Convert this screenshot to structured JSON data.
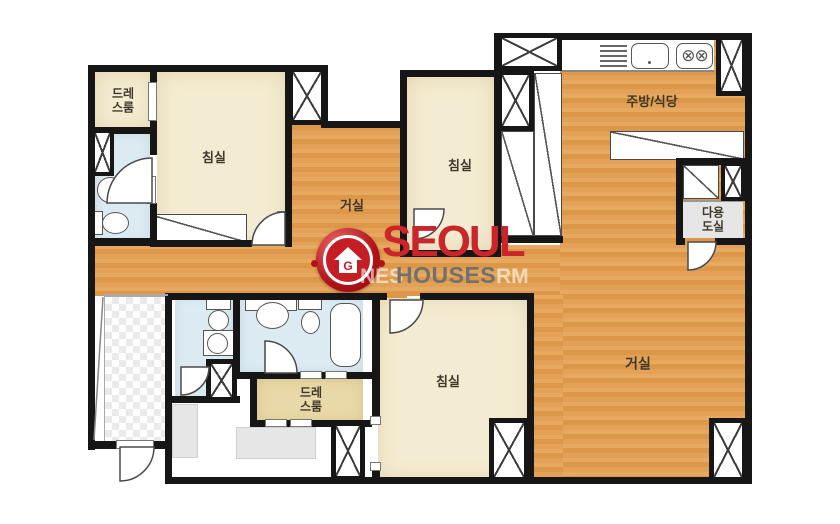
{
  "palette": {
    "wall": "#161616",
    "wood_floor": "#de9a4c",
    "room_beige": "#f4ecd2",
    "dress_beige": "#ead9a8",
    "bath_blue": "#dcebf2",
    "utility_gray": "#e6e6e6",
    "logo_red": "#c9252b",
    "logo_gray": "#707070"
  },
  "rooms": {
    "dress_top": {
      "line1": "드레",
      "line2": "스룸"
    },
    "bedroom_nw": {
      "label": "침실"
    },
    "hall": {
      "label": "거실"
    },
    "bedroom_n": {
      "label": "침실"
    },
    "kitchen": {
      "label": "주방/식당"
    },
    "utility": {
      "line1": "다용",
      "line2": "도실"
    },
    "living": {
      "label": "거실"
    },
    "bedroom_s": {
      "label": "침실"
    },
    "dress_bottom": {
      "line1": "드레",
      "line2": "스룸"
    }
  },
  "logo": {
    "name": "SEOUL",
    "sub": "HOUSES",
    "wm_left": "NES",
    "wm_right": "RM"
  }
}
